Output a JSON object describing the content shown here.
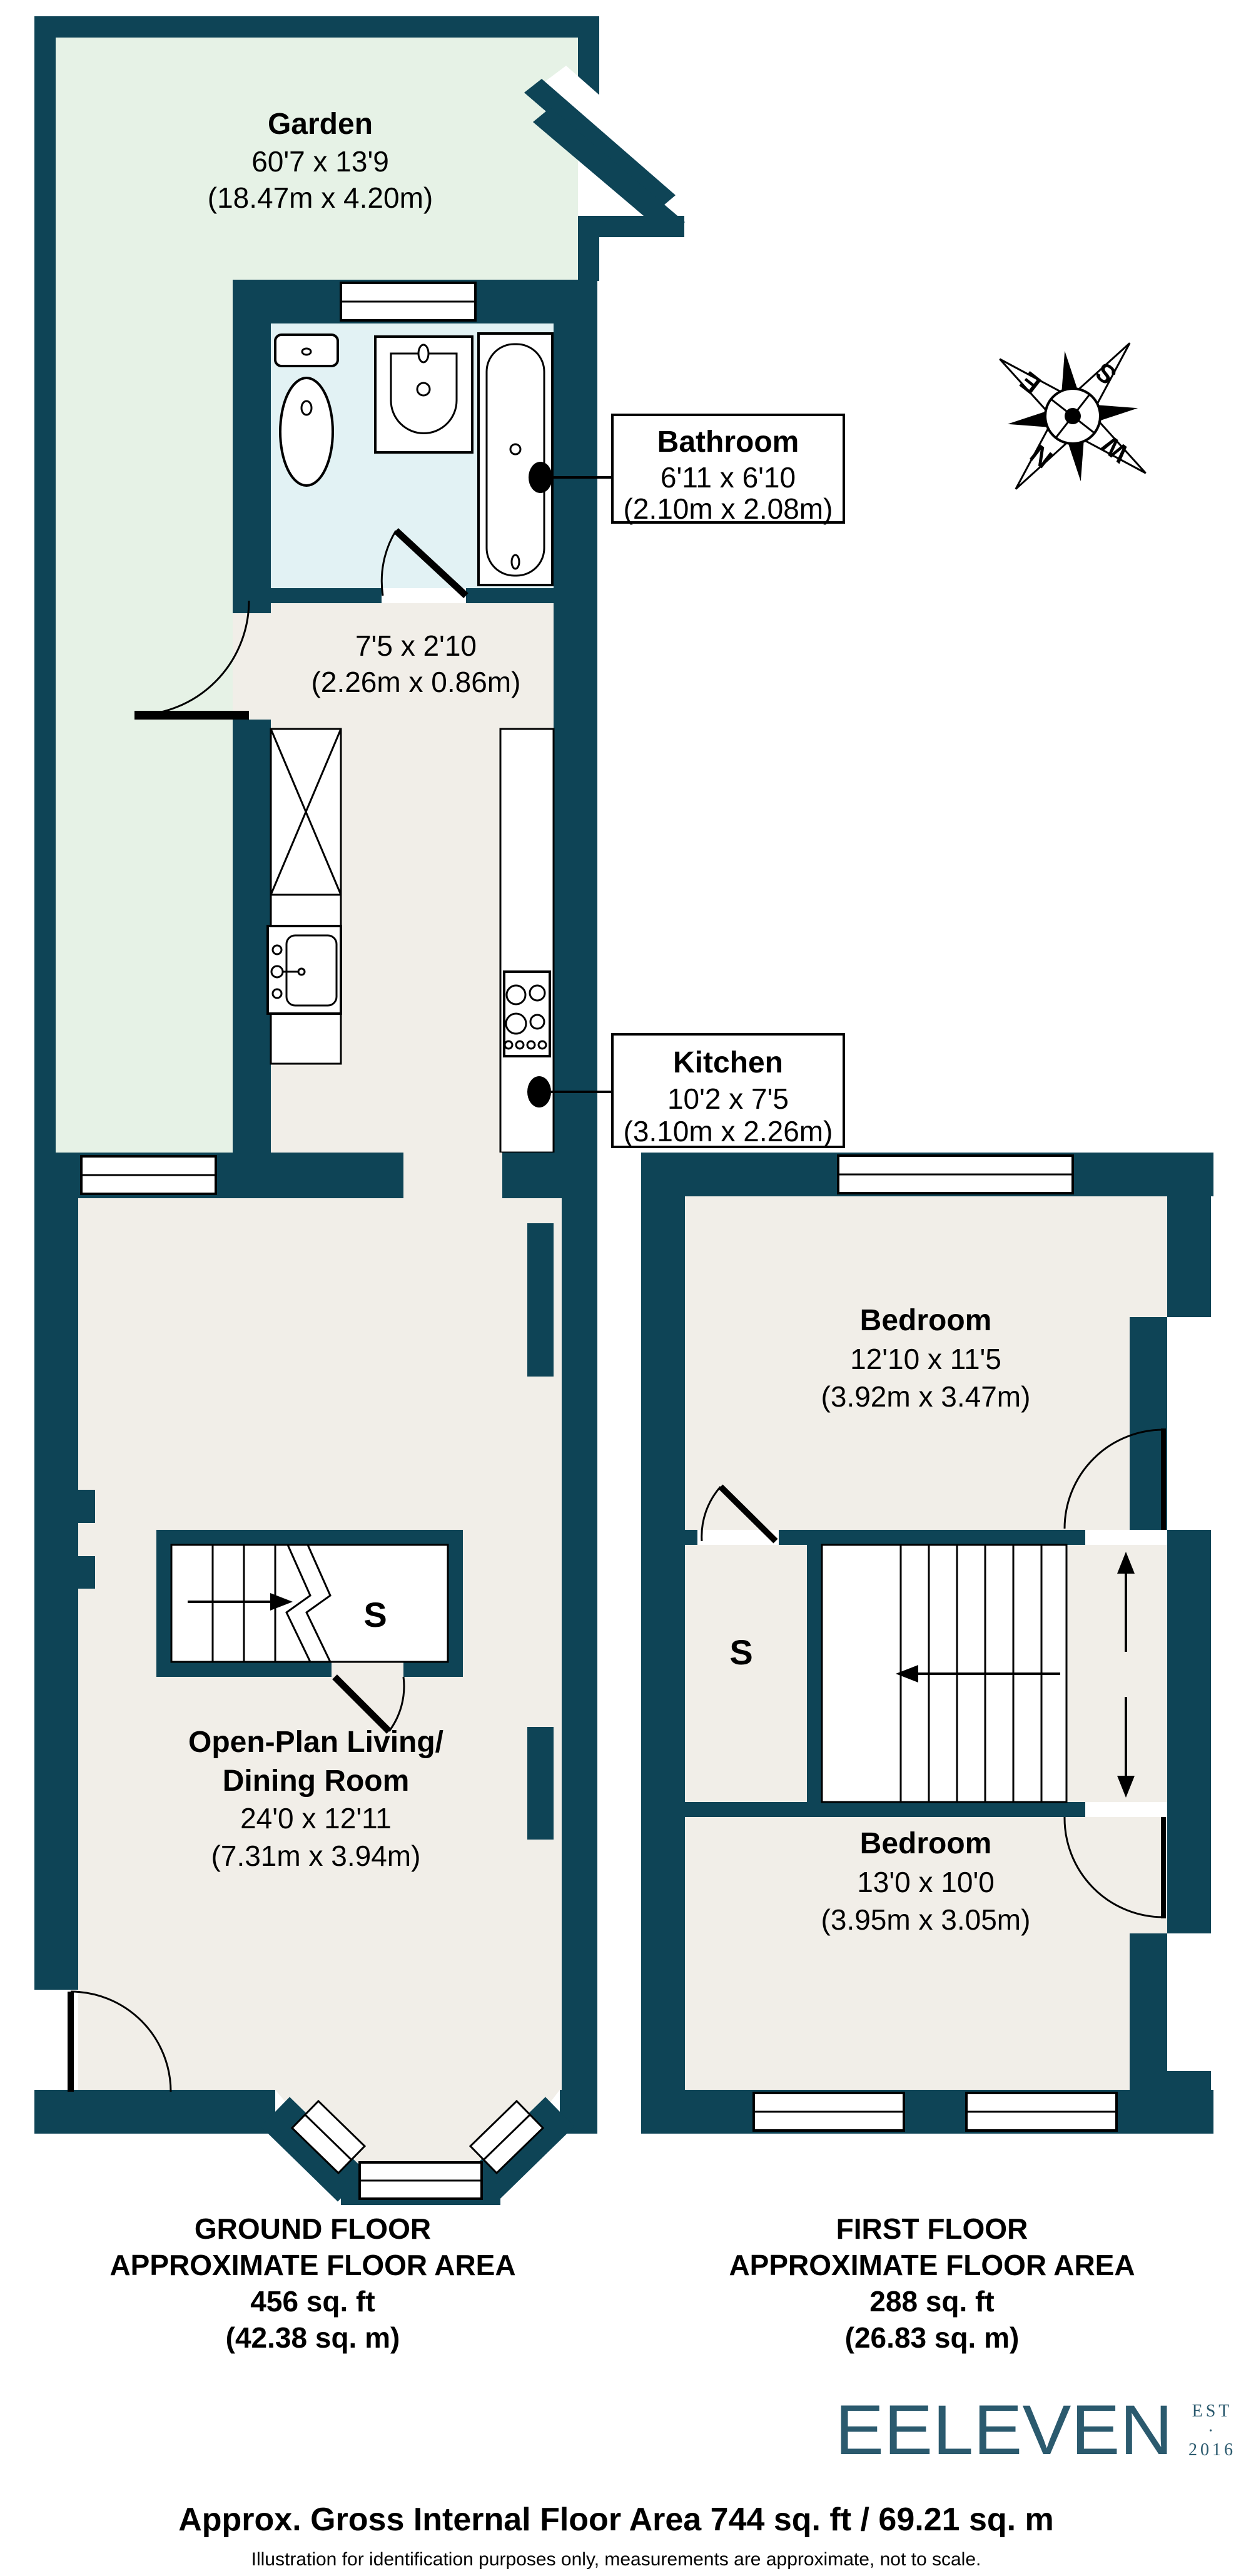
{
  "colors": {
    "wall": "#0e4456",
    "floor": "#f1eee8",
    "garden": "#e6f2e6",
    "bathroom": "#e2f2f4",
    "fixture_outline": "#000000",
    "logo_teal": "#2b5a6e"
  },
  "rooms": {
    "garden": {
      "name": "Garden",
      "imperial": "60'7 x 13'9",
      "metric": "(18.47m x 4.20m)"
    },
    "bathroom": {
      "name": "Bathroom",
      "imperial": "6'11 x 6'10",
      "metric": "(2.10m x 2.08m)"
    },
    "hallway": {
      "imperial": "7'5 x 2'10",
      "metric": "(2.26m x 0.86m)"
    },
    "kitchen": {
      "name": "Kitchen",
      "imperial": "10'2 x 7'5",
      "metric": "(3.10m x 2.26m)"
    },
    "living_room": {
      "name_line1": "Open-Plan Living/",
      "name_line2": "Dining Room",
      "imperial": "24'0 x 12'11",
      "metric": "(7.31m x 3.94m)"
    },
    "bedroom_front": {
      "name": "Bedroom",
      "imperial": "12'10 x 11'5",
      "metric": "(3.92m x 3.47m)"
    },
    "bedroom_back": {
      "name": "Bedroom",
      "imperial": "13'0 x 10'0",
      "metric": "(3.95m x 3.05m)"
    },
    "storage_ground": {
      "label": "S"
    },
    "storage_first": {
      "label": "S"
    }
  },
  "floor_summaries": {
    "ground": {
      "line1": "GROUND FLOOR",
      "line2": "APPROXIMATE FLOOR AREA",
      "line3": "456 sq. ft",
      "line4": "(42.38 sq. m)"
    },
    "first": {
      "line1": "FIRST FLOOR",
      "line2": "APPROXIMATE FLOOR AREA",
      "line3": "288 sq. ft",
      "line4": "(26.83 sq. m)"
    }
  },
  "compass": {
    "north": "N",
    "east": "E",
    "south": "S",
    "west": "W"
  },
  "logo": {
    "brand": "EELEVEN",
    "est": "EST",
    "separator": "·",
    "year": "2016"
  },
  "footer": {
    "gross_area": "Approx. Gross Internal Floor Area 744 sq. ft / 69.21 sq. m",
    "disclaimer": "Illustration for identification purposes only, measurements are approximate, not to scale."
  }
}
